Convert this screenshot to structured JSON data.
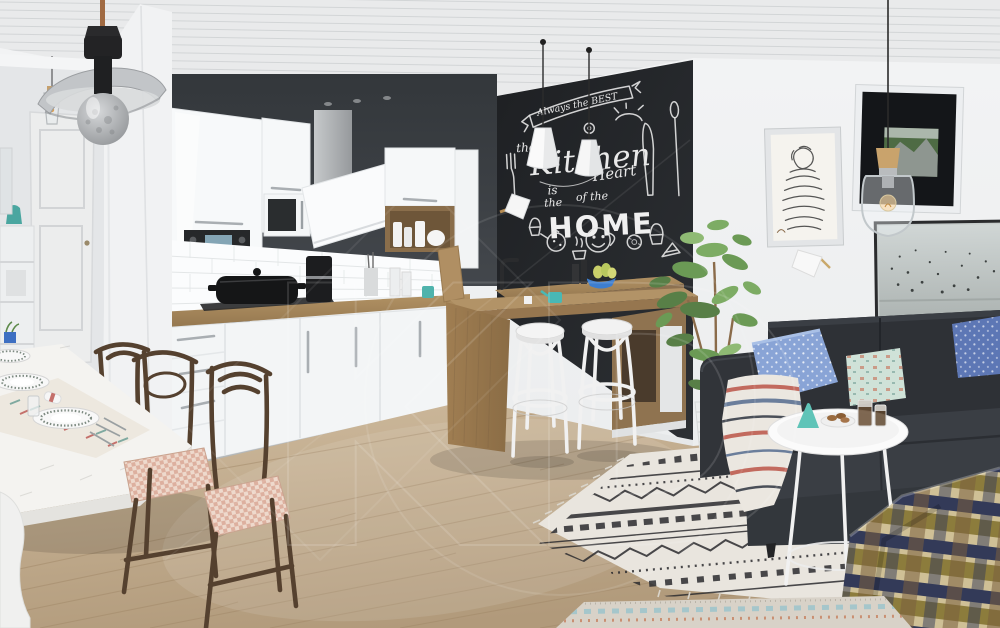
{
  "scene": {
    "description": "Scandinavian open-plan interior render: white gloss kitchen with chalkboard wall, wooden bar counter with two white bentwood stools, shabby-chic white dining table with dark wood chairs, charcoal sofa with blue pillows, gallery wall, boho rug and plaid throw",
    "chalkboard": {
      "banner_text": "Always the BEST",
      "the_small": "the",
      "kitchen_script": "Kitchen",
      "is_text": "is",
      "the_text": "the",
      "heart_script": "Heart",
      "of_the_text": "of the",
      "home_caps": "HOME"
    },
    "watermark_text": "KD"
  },
  "palette": {
    "chalkboard": "#212427",
    "dark_wall_strip": "#3b3f43",
    "cabinet_white": "#f7f9fa",
    "wood_counter": "#a8895e",
    "floor_wood": "#c4ae8f",
    "sofa_charcoal": "#30343a",
    "pillow_blue": "#89a4d6",
    "pillow_mint": "#cfe2d8",
    "accent_teal": "#5fc4b8",
    "rug_cream": "#e8e4dd",
    "rug_black": "#2b2b2f",
    "plant_green": "#6f9a58",
    "stool_white": "#f2f2f2",
    "plaid_olive": "#8c7c3c",
    "plaid_navy": "#333a58"
  }
}
